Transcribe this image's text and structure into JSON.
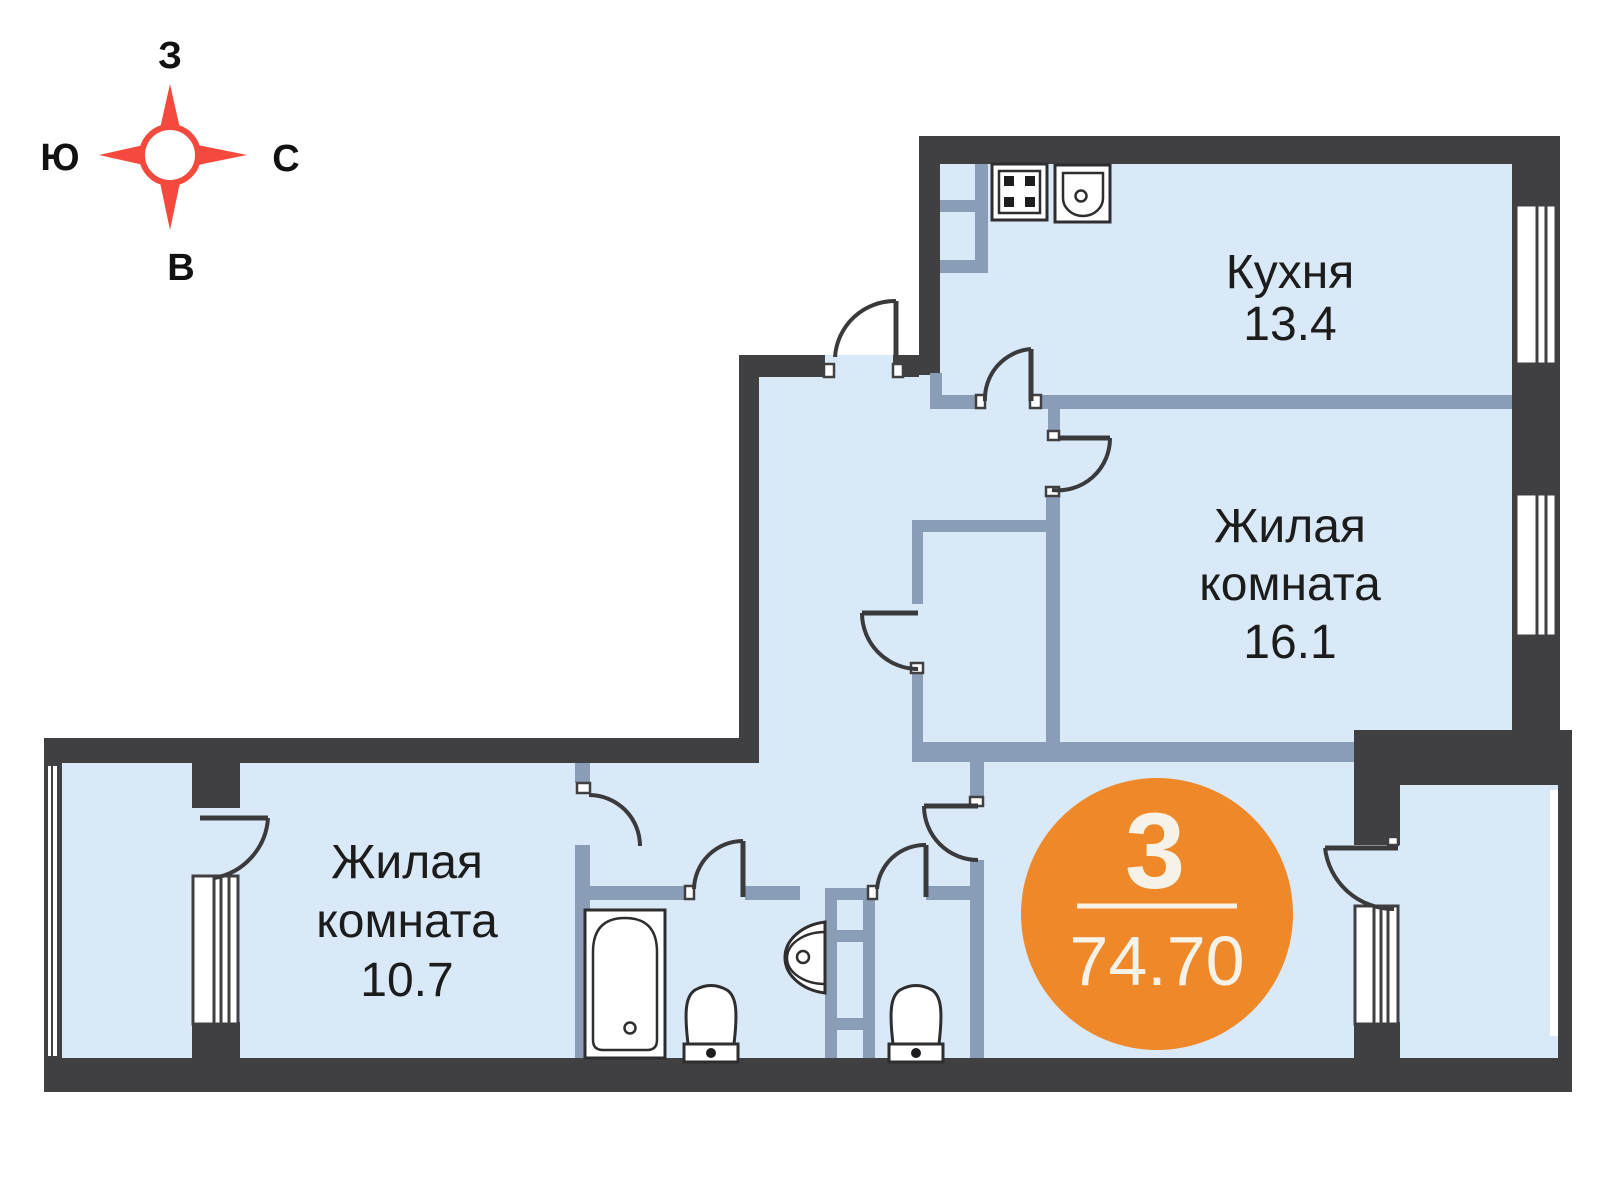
{
  "compass": {
    "west": "З",
    "south": "Ю",
    "north": "С",
    "east": "В"
  },
  "rooms": {
    "kitchen": {
      "lines": [
        "Кухня",
        "13.4"
      ]
    },
    "living_large": {
      "lines": [
        "Жилая",
        "комната",
        "16.1"
      ]
    },
    "living_small": {
      "lines": [
        "Жилая",
        "комната",
        "10.7"
      ]
    }
  },
  "badge": {
    "rooms": "3",
    "total_area": "74.70"
  },
  "colors": {
    "wall": "#404042",
    "partition": "#8a9db6",
    "floor": "#d9e9f7",
    "outline": "#3a3a3c",
    "compass_red": "#f4493c",
    "badge_orange": "#ef8829",
    "badge_text": "#f7f2e7",
    "label_text": "#1c1c1c"
  }
}
